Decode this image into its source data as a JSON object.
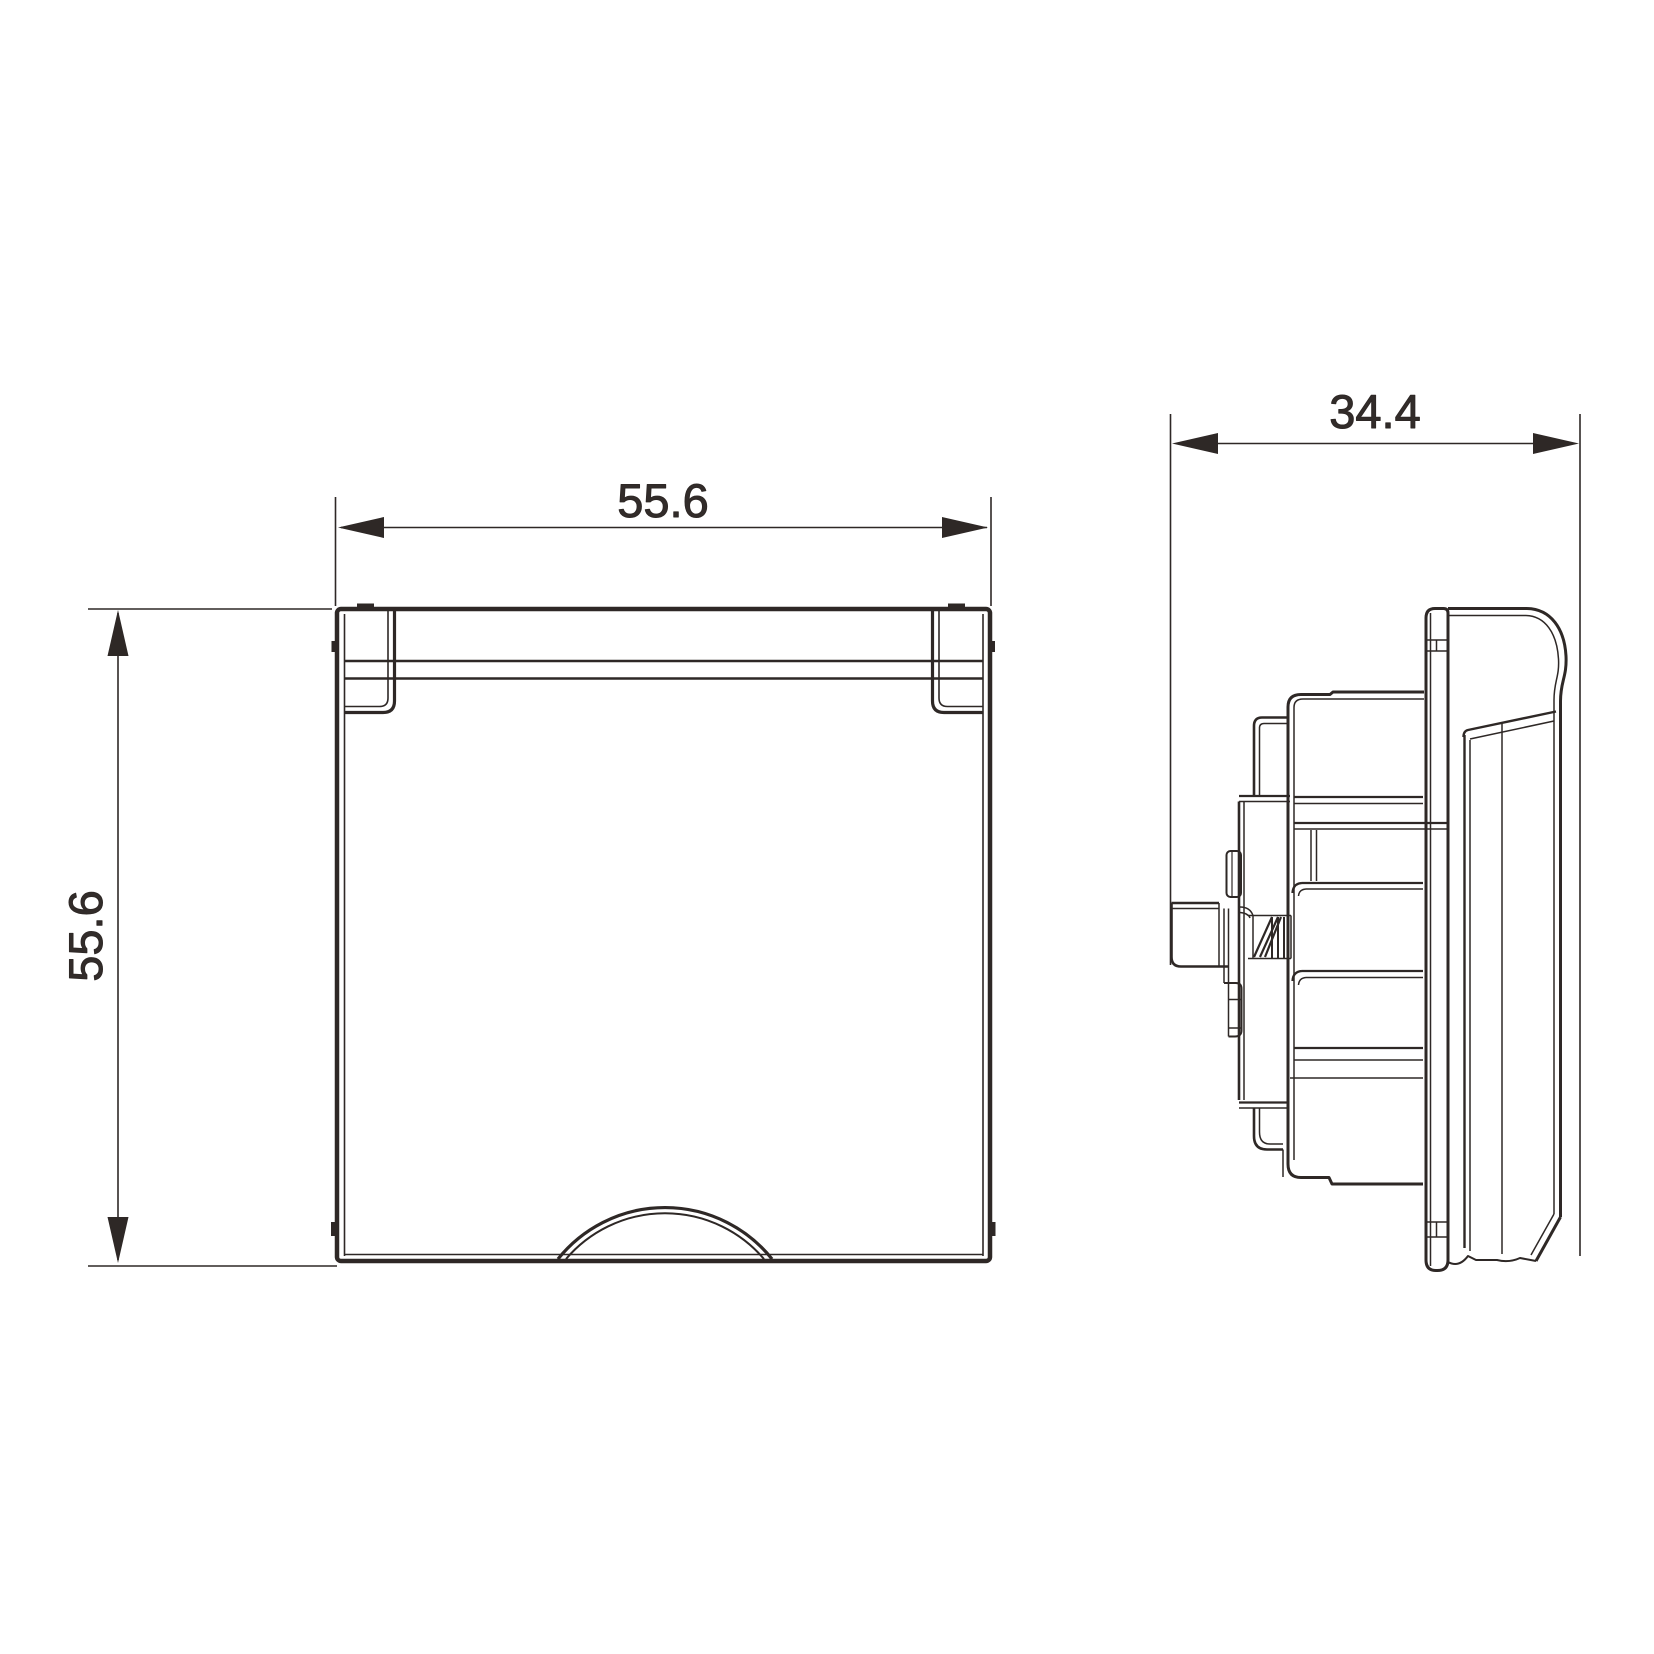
{
  "drawing": {
    "type": "technical-drawing-two-views",
    "views": {
      "front": {
        "name": "front-view-socket-cover",
        "width_label": "55.6",
        "height_label": "55.6"
      },
      "side": {
        "name": "side-view-socket-depth",
        "depth_label": "34.4"
      }
    },
    "colors": {
      "line": "#2e2826",
      "text": "#322c2a",
      "background": "#ffffff"
    }
  }
}
